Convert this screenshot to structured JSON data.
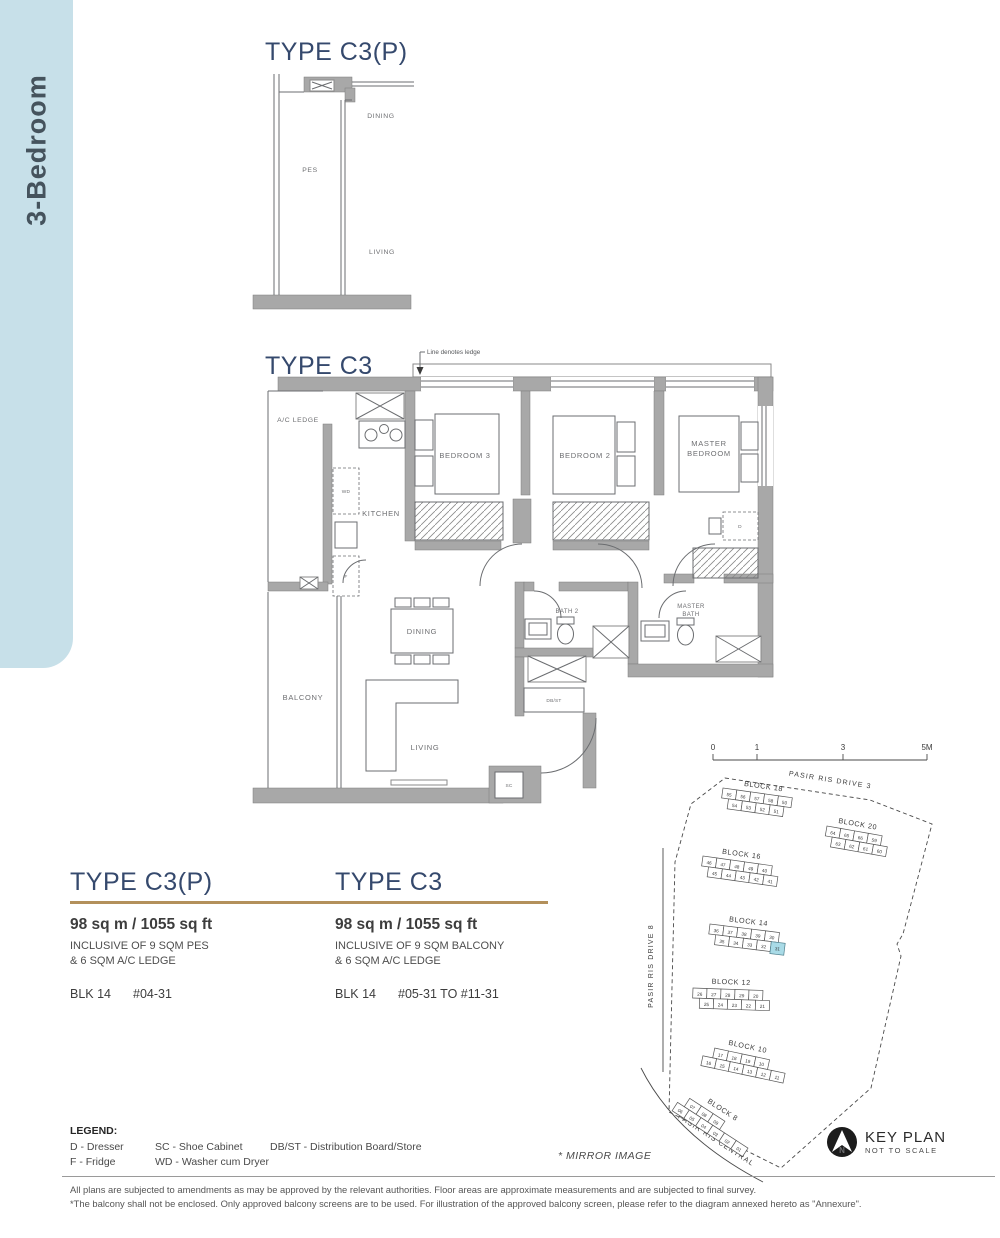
{
  "sidebar": {
    "label": "3-Bedroom"
  },
  "plan_cp": {
    "title": "TYPE C3(P)",
    "labels": {
      "pes": "PES",
      "dining": "DINING",
      "living": "LIVING"
    }
  },
  "plan_c3": {
    "title": "TYPE C3",
    "ledge_note": "Line denotes ledge",
    "rooms": {
      "ac_ledge": "A/C LEDGE",
      "kitchen": "KITCHEN",
      "bedroom3": "BEDROOM 3",
      "bedroom2": "BEDROOM 2",
      "master1": "MASTER",
      "master2": "BEDROOM",
      "bath2": "BATH 2",
      "mbath1": "MASTER",
      "mbath2": "BATH",
      "dining": "DINING",
      "balcony": "BALCONY",
      "living": "LIVING",
      "dbst": "DB/ST",
      "sc": "SC",
      "wd": "WD",
      "f": "F",
      "d": "D"
    }
  },
  "specs": [
    {
      "title": "TYPE C3(P)",
      "area": "98 sq m / 1055 sq ft",
      "inclusive1": "INCLUSIVE OF 9 SQM PES",
      "inclusive2": "& 6 SQM A/C LEDGE",
      "block": "BLK 14",
      "units": "#04-31"
    },
    {
      "title": "TYPE C3",
      "area": "98 sq m / 1055 sq ft",
      "inclusive1": "INCLUSIVE OF 9 SQM BALCONY",
      "inclusive2": "& 6 SQM A/C LEDGE",
      "block": "BLK 14",
      "units": "#05-31 TO #11-31"
    }
  ],
  "legend": {
    "heading": "LEGEND:",
    "col1": [
      "D - Dresser",
      "F - Fridge"
    ],
    "col2": [
      "SC - Shoe Cabinet",
      "WD - Washer cum Dryer"
    ],
    "col3": [
      "DB/ST - Distribution Board/Store"
    ]
  },
  "notes": {
    "mirror": "* MIRROR IMAGE"
  },
  "keyplan": {
    "caption": {
      "title": "KEY PLAN",
      "sub": "NOT TO SCALE",
      "north": "N"
    },
    "scale": [
      "0",
      "1",
      "3",
      "5M"
    ],
    "roads": [
      "PASIR RIS DRIVE 3",
      "PASIR RIS DRIVE 8",
      "PASIR RIS CENTRAL"
    ],
    "highlight_unit": "31",
    "highlight_color": "#a9dbe7",
    "blocks": [
      {
        "name": "BLOCK 18",
        "rows": [
          [
            "55",
            "56",
            "57",
            "58",
            "50"
          ],
          [
            "54",
            "53",
            "52",
            "51"
          ]
        ]
      },
      {
        "name": "BLOCK 20",
        "rows": [
          [
            "64",
            "65",
            "66",
            "59"
          ],
          [
            "63",
            "62",
            "61",
            "60"
          ]
        ]
      },
      {
        "name": "BLOCK 16",
        "rows": [
          [
            "46",
            "47",
            "48",
            "49",
            "40"
          ],
          [
            "45",
            "44",
            "43",
            "42",
            "41"
          ]
        ]
      },
      {
        "name": "BLOCK 14",
        "rows": [
          [
            "36",
            "37",
            "38",
            "39",
            "30"
          ],
          [
            "35",
            "34",
            "33",
            "32",
            "31"
          ]
        ]
      },
      {
        "name": "BLOCK 12",
        "rows": [
          [
            "26",
            "27",
            "28",
            "29",
            "20"
          ],
          [
            "25",
            "24",
            "23",
            "22",
            "21"
          ]
        ]
      },
      {
        "name": "BLOCK 10",
        "rows": [
          [
            "17",
            "18",
            "19",
            "10"
          ],
          [
            "16",
            "15",
            "14",
            "13",
            "12",
            "11"
          ]
        ]
      },
      {
        "name": "BLOCK 8",
        "rows": [
          [
            "07",
            "08",
            "09"
          ],
          [
            "06",
            "05",
            "04",
            "03",
            "02",
            "01"
          ]
        ]
      }
    ]
  },
  "footer": {
    "line1": "All plans are subjected to amendments as may be approved by the relevant authorities. Floor areas are approximate measurements and are subjected to final survey.",
    "line2": "*The balcony shall not be enclosed. Only approved balcony screens are to be used. For illustration of the approved balcony screen, please refer to the diagram annexed hereto as \"Annexure\"."
  },
  "colors": {
    "accent_navy": "#35496d",
    "accent_gold": "#b3905b",
    "tab_blue": "#c7e0e9",
    "wall_gray": "#a8a8a8",
    "highlight_blue": "#a9dbe7"
  }
}
